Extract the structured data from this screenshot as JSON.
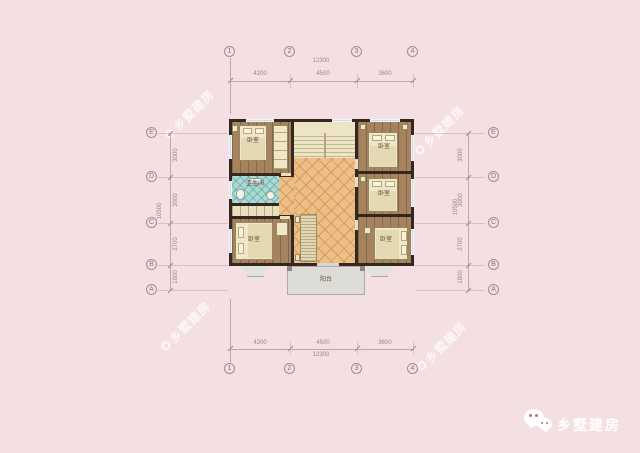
{
  "watermark": {
    "text": "乡墅建房"
  },
  "brand": {
    "label": "乡墅建房",
    "icon": "wechat-bubbles-icon"
  },
  "axes": {
    "cols": [
      "1",
      "2",
      "3",
      "4"
    ],
    "rows": [
      "E",
      "D",
      "C",
      "B",
      "A"
    ]
  },
  "dims": {
    "width_total": "12300",
    "width_segments": [
      "4200",
      "4500",
      "3600"
    ],
    "height_total": "10500",
    "height_segments": [
      "3000",
      "3000",
      "2700",
      "1800"
    ]
  },
  "rooms": {
    "bedroom_top_left": "卧室",
    "bedroom_top_right": "卧室",
    "bedroom_mid_right": "卧室",
    "bedroom_bottom_left": "卧室",
    "bedroom_bottom_right": "卧室",
    "bathroom": "卫生间",
    "balcony": "阳台"
  },
  "colors": {
    "background": "#f4dfe2",
    "wall": "#32281f",
    "wood_floor": "#a5835f",
    "hall_tile": "#edbe86",
    "bath_tile": "#abd9d3",
    "furniture": "#efe7c8",
    "balcony": "#dedcd6",
    "annotation": "#9f8489",
    "brand_text": "#ffffff"
  }
}
